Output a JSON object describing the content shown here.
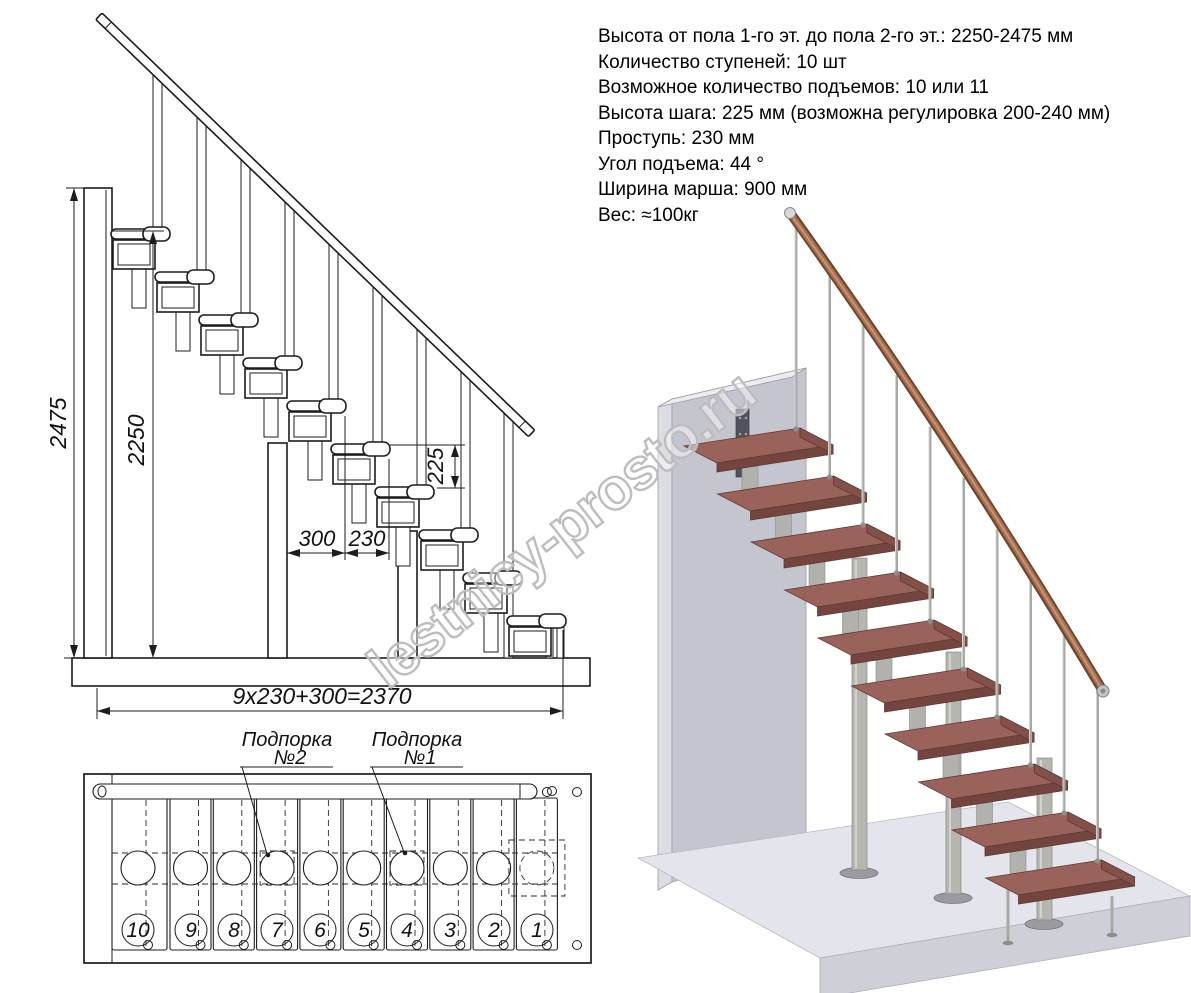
{
  "specs": {
    "lines": [
      "Высота от пола 1-го эт. до пола 2-го эт.: 2250-2475 мм",
      "Количество ступеней: 10 шт",
      "Возможное количество подъемов: 10 или 11",
      "Высота шага: 225 мм (возможна регулировка 200-240 мм)",
      "Проступь: 230 мм",
      "Угол подъема: 44 °",
      "Ширина марша: 900 мм",
      "Вес: ≈100кг"
    ]
  },
  "elevation": {
    "dims": {
      "total_height": "2475",
      "to_top_tread": "2250",
      "riser": "225",
      "top_run": "300",
      "tread_depth": "230",
      "total_run": "9x230+300=2370"
    }
  },
  "plan": {
    "support2": {
      "line1": "Подпорка",
      "line2": "№2"
    },
    "support1": {
      "line1": "Подпорка",
      "line2": "№1"
    },
    "step_numbers": [
      "10",
      "9",
      "8",
      "7",
      "6",
      "5",
      "4",
      "3",
      "2",
      "1"
    ]
  },
  "watermark": "lestnicy-prosto.ru"
}
